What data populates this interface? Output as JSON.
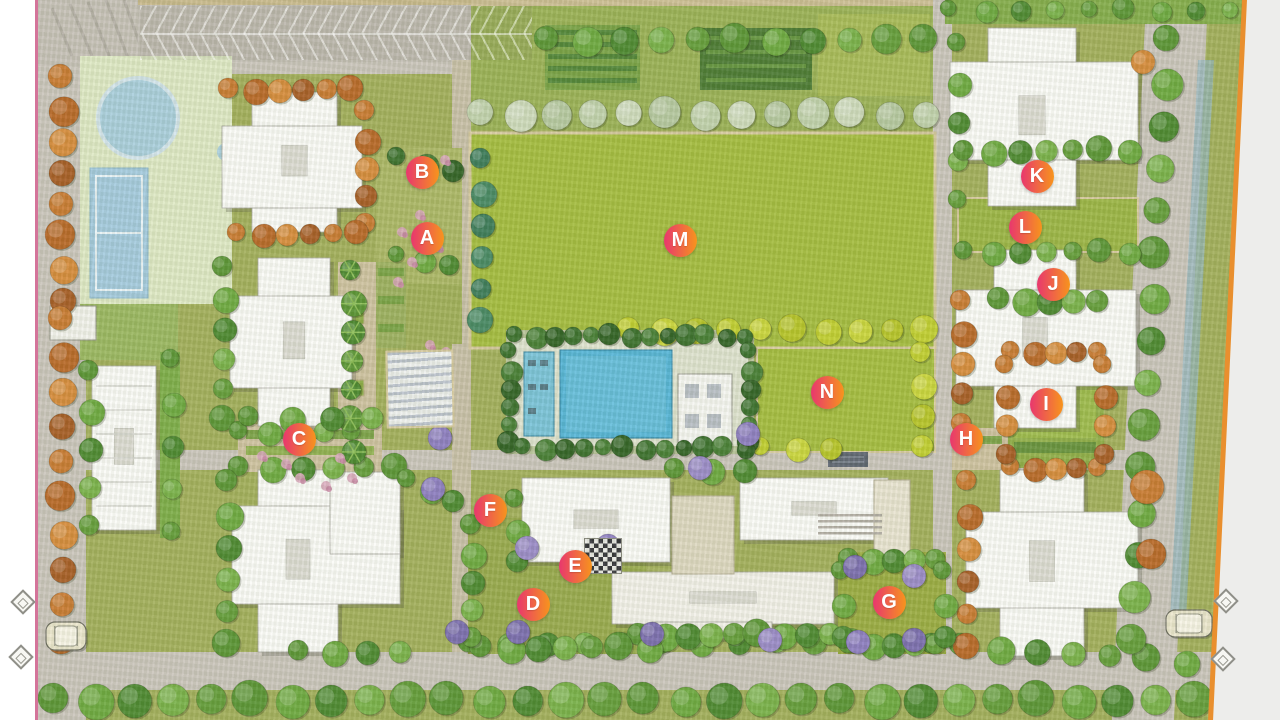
{
  "map": {
    "type": "residential-site-master-plan",
    "markers": [
      {
        "label": "A",
        "x": 427,
        "y": 238
      },
      {
        "label": "B",
        "x": 422,
        "y": 172
      },
      {
        "label": "C",
        "x": 299,
        "y": 439
      },
      {
        "label": "D",
        "x": 533,
        "y": 604
      },
      {
        "label": "E",
        "x": 575,
        "y": 566
      },
      {
        "label": "F",
        "x": 490,
        "y": 510
      },
      {
        "label": "G",
        "x": 889,
        "y": 602
      },
      {
        "label": "H",
        "x": 966,
        "y": 439
      },
      {
        "label": "I",
        "x": 1046,
        "y": 404
      },
      {
        "label": "J",
        "x": 1053,
        "y": 284
      },
      {
        "label": "K",
        "x": 1037,
        "y": 176
      },
      {
        "label": "L",
        "x": 1025,
        "y": 227
      },
      {
        "label": "M",
        "x": 680,
        "y": 240
      },
      {
        "label": "N",
        "x": 827,
        "y": 392
      }
    ],
    "vehicles": [
      {
        "icon": "car-icon",
        "x": 46,
        "y": 622,
        "w": 40,
        "h": 28
      },
      {
        "icon": "car-icon",
        "x": 1166,
        "y": 610,
        "w": 46,
        "h": 27
      }
    ],
    "entry_arrows": [
      {
        "icon": "entry-arrow-icon",
        "x": 14,
        "y": 593
      },
      {
        "icon": "entry-arrow-icon",
        "x": 12,
        "y": 648
      },
      {
        "icon": "entry-arrow-icon",
        "x": 1217,
        "y": 592
      },
      {
        "icon": "entry-arrow-icon",
        "x": 1214,
        "y": 650
      }
    ],
    "palette": {
      "marker_gradient_start": "#e8376e",
      "marker_gradient_end": "#f7941d",
      "lawn_base": "#a4b05e",
      "lawn_bright": "#a6bd42",
      "road": "#cbc6bd",
      "path_tan": "#cfc3a2",
      "building": "#fbfbf8",
      "pool_water": "#58b6d8",
      "court_blue": "#a6cbdf",
      "hedge_dark": "#4d7c3a",
      "border_left": "#d4749a",
      "border_right": "#e98f2e",
      "margin_right_bg": "#ededeb"
    }
  }
}
